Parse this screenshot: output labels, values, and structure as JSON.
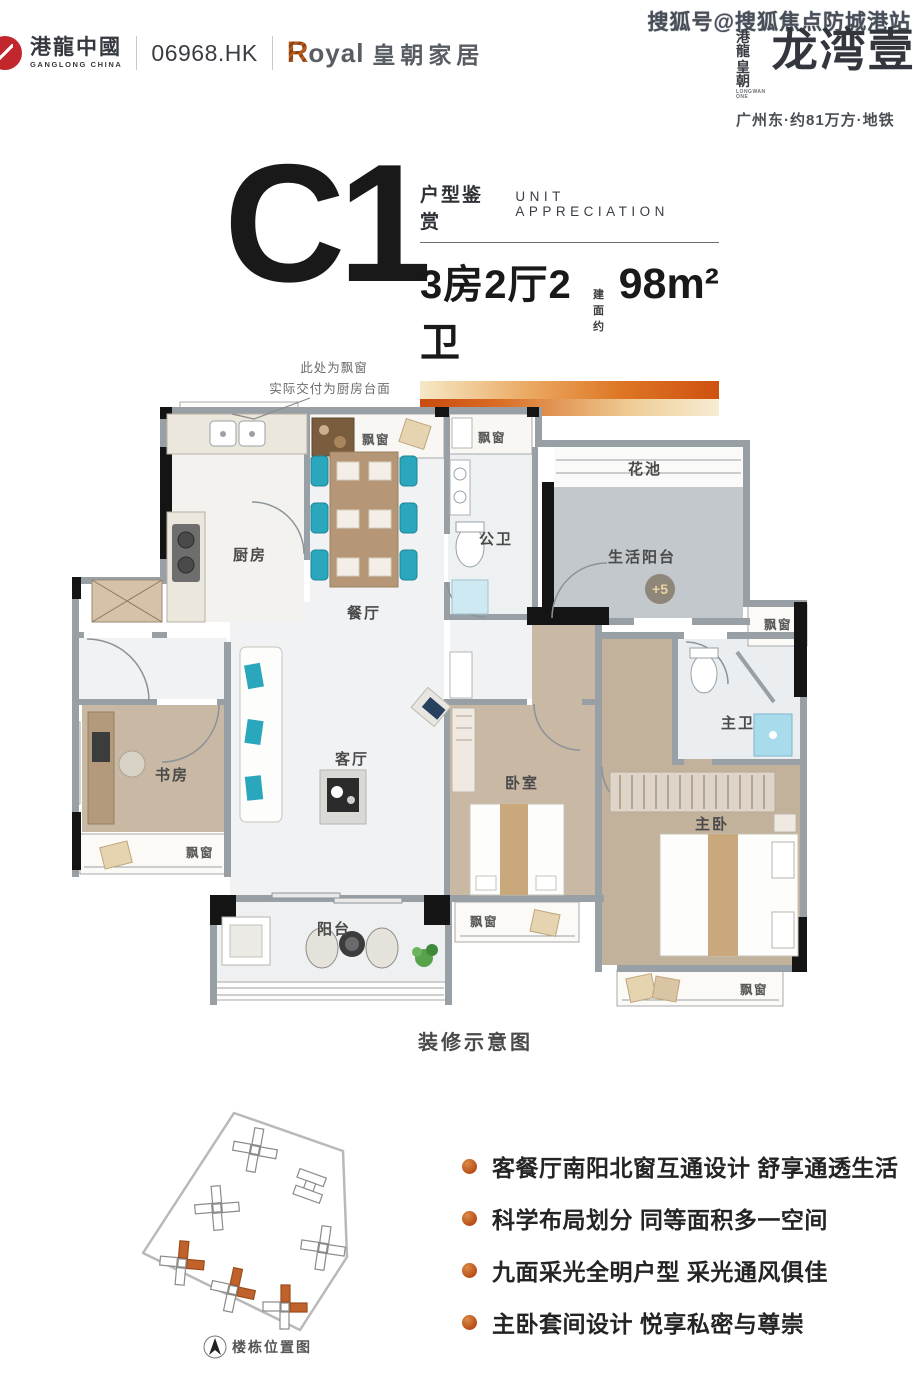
{
  "header": {
    "company_name": "港龍中國",
    "company_name_en": "GANGLONG CHINA",
    "stock_code": "06968.HK",
    "furniture_brand_r": "R",
    "furniture_brand_rest": "oyal",
    "furniture_brand_cn": "皇朝家居",
    "watermark": "搜狐号@搜狐焦点防城港站",
    "project_brand_top": "港龍",
    "project_brand_bottom": "皇朝",
    "project_brand_en": "LONGWAN ONE",
    "project_name": "龙湾壹",
    "project_tagline": "广州东·约81万方·地铁"
  },
  "unit": {
    "code": "C1",
    "section_title": "户型鉴赏",
    "section_title_en": "UNIT APPRECIATION",
    "layout": "3房2厅2卫",
    "area_label": "建面约",
    "area_value": "98m²"
  },
  "floorplan": {
    "annotation_line1": "此处为飘窗",
    "annotation_line2": "实际交付为厨房台面",
    "caption": "装修示意图",
    "rooms": {
      "kitchen": "厨房",
      "dining": "餐厅",
      "living": "客厅",
      "study": "书房",
      "bedroom": "卧室",
      "master_bedroom": "主卧",
      "master_bath": "主卫",
      "guest_bath": "公卫",
      "balcony": "阳台",
      "service_balcony": "生活阳台",
      "flower_bed": "花池",
      "bay_window": "飘窗",
      "floor_badge": "+5"
    }
  },
  "sitemap": {
    "caption": "楼栋位置图"
  },
  "highlights": {
    "items": [
      "客餐厅南阳北窗互通设计 舒享通透生活",
      "科学布局划分 同等面积多一空间",
      "九面采光全明户型 采光通风俱佳",
      "主卧套间设计 悦享私密与尊崇"
    ]
  },
  "colors": {
    "accent_orange": "#d2691e",
    "accent_deep": "#c04a12",
    "wall_gray": "#98a0a6",
    "wood_floor": "#c9b8a3",
    "teal": "#2aa7bd"
  }
}
